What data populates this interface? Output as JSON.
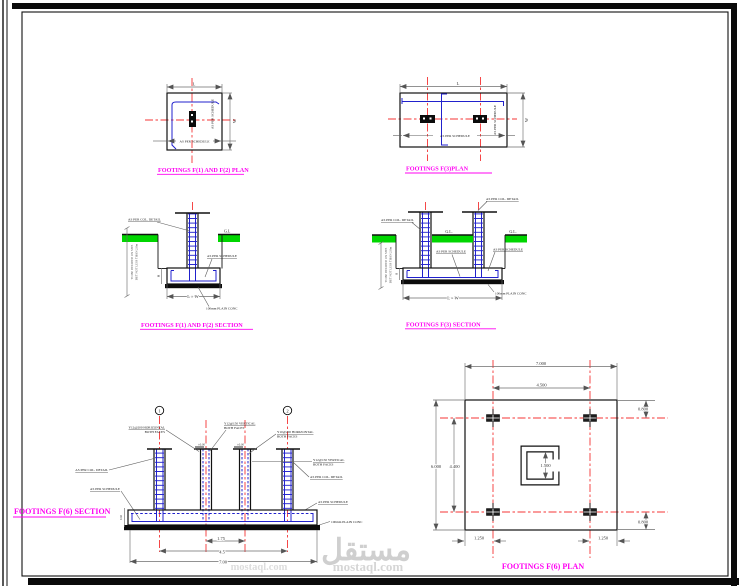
{
  "sheet": {
    "watermark_arabic": "مستقل",
    "watermark_latin": "mostaql.com",
    "title_color": "#ff00f2",
    "centerline_color": "#f43434",
    "rebar_color": "#2121cc",
    "ground_color": "#00d600"
  },
  "f12_plan": {
    "title": "FOOTINGS F(1) AND F(2) PLAN",
    "dim_l": "L",
    "dim_w": "W",
    "schedule_h": "AS PER SCHEDULE",
    "schedule_v": "AS PER SCHEDULE"
  },
  "f3_plan": {
    "title": "FOOTINGS F(3)PLAN",
    "dim_l": "L",
    "dim_w": "W",
    "schedule_h": "AS PER SCHEDULE",
    "schedule_v": "AS PER SCHEDULE"
  },
  "f12_section": {
    "title": "FOOTINGS F(1) AND F(2) SECTION",
    "col_detail": "AS PER COL. DETAIL",
    "gl": "G.L",
    "schedule": "AS PER SCHEDULE",
    "plain_conc": "100mm PLAIN CONC",
    "dim_lw": "L × W",
    "dim_h": "H",
    "note_line1": "TO BE DECIDED ON SITE",
    "note_line2": "BUT NOT LESS THAN 2.0m"
  },
  "f3_section": {
    "title": "FOOTINGS F(3)  SECTION",
    "col_detail": "AS PER COL. DETAIL",
    "gl": "G.L.",
    "schedule": "AS PER SCHEDULE",
    "plain_conc": "100mm PLAIN CONC",
    "dim_lw": "L × W",
    "dim_h": "H",
    "note_line1": "TO BE DECIDED ON SITE",
    "note_line2": "BUT NOT LESS THAN 2.0m"
  },
  "f6_section": {
    "title": "FOOTINGS F(6) SECTION",
    "grid_bubble_1": "1",
    "grid_bubble_2": "2",
    "level": "±0.00",
    "rebar_left_1": "Y12@200 HORIZONTAL",
    "rebar_left_2": "BOTH FACES",
    "rebar_mid_1": "Y12@150 VERTICAL",
    "rebar_mid_2": "BOTH FACES",
    "rebar_right_1": "Y10@200 HORIZONTAL",
    "rebar_right_2": "BOTH FACES",
    "rebar_far_right_1": "Y12@150 VERTICAL",
    "rebar_far_right_2": "BOTH FACES",
    "col_detail": "AS PER COL. DETAIL",
    "schedule": "AS PER SCHEDULE",
    "plain_conc": "100mm PLAIN CONC",
    "dim_inner": "1.75",
    "dim_mid": "4.5",
    "dim_overall": "7.00",
    "dim_depth": "0.60"
  },
  "f6_plan": {
    "title": "FOOTINGS F(6) PLAN",
    "dim_top_overall": "7.000",
    "dim_top_inner": "4.500",
    "dim_left_overall": "6.000",
    "dim_left_inner": "4.400",
    "dim_right_top": "0.800",
    "dim_right_bottom": "0.800",
    "dim_bottom_left": "1.250",
    "dim_bottom_right": "1.250",
    "dim_core": "1.500"
  }
}
